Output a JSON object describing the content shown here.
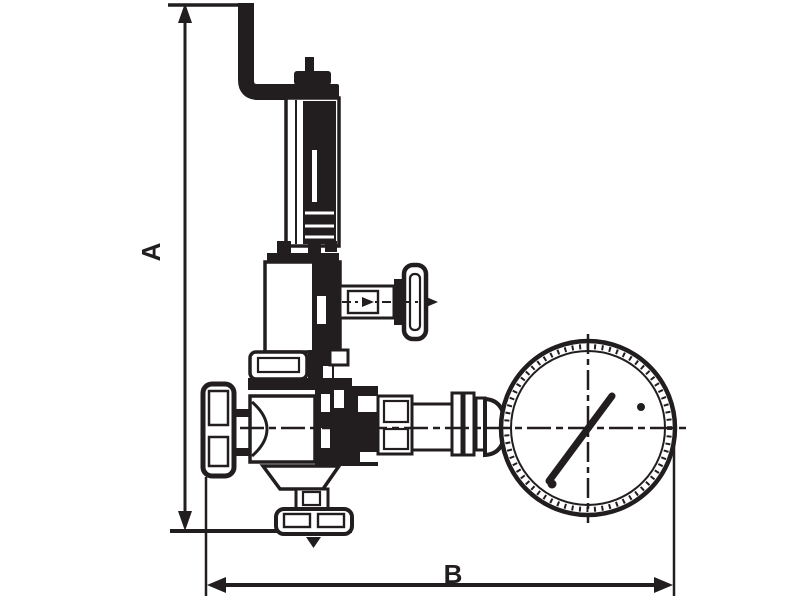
{
  "drawing": {
    "ink_color": "#221e1f",
    "background_color": "#ffffff",
    "dimension_labels": {
      "vertical": "A",
      "horizontal": "B"
    }
  }
}
